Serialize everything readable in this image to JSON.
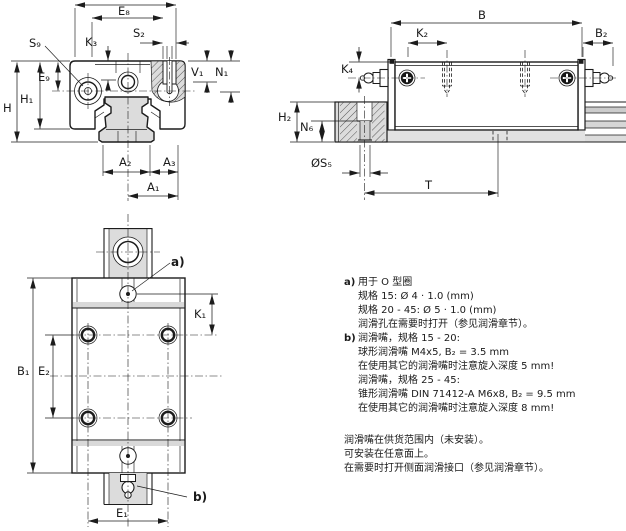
{
  "drawing": {
    "front_view": {
      "labels": {
        "e8": "E₈",
        "s9": "S₉",
        "k3": "K₃",
        "s2": "S₂",
        "v1": "V₁",
        "n1": "N₁",
        "h": "H",
        "h1": "H₁",
        "e9": "E₉",
        "a2": "A₂",
        "a3": "A₃",
        "a1": "A₁"
      }
    },
    "side_view": {
      "labels": {
        "b": "B",
        "k2": "K₂",
        "b2": "B₂",
        "k4": "K₄",
        "h2": "H₂",
        "n6": "N₆",
        "s5": "ØS₅",
        "t": "T"
      }
    },
    "top_view": {
      "labels": {
        "a_marker": "a)",
        "b_marker": "b)",
        "k1": "K₁",
        "b1": "B₁",
        "e2": "E₂",
        "e1": "E₁"
      }
    }
  },
  "notes": {
    "item_a": {
      "marker": "a)",
      "lines": [
        "用于 O 型圈",
        "规格 15: Ø 4 · 1.0 (mm)",
        "规格 20 - 45: Ø 5 · 1.0 (mm)",
        "润滑孔在需要时打开（参见润滑章节）。"
      ]
    },
    "item_b": {
      "marker": "b)",
      "lines": [
        "润滑嘴，规格 15 - 20:",
        "球形润滑嘴 M4x5, B₂ = 3.5 mm",
        "在使用其它的润滑嘴时注意旋入深度 5 mm!",
        "润滑嘴，规格 25 - 45:",
        "锥形润滑嘴 DIN 71412-A M6x8, B₂ = 9.5 mm",
        "在使用其它的润滑嘴时注意旋入深度 8 mm!"
      ]
    },
    "footer": [
      "润滑嘴在供货范围内（未安装）。",
      "可安装在任意面上。",
      "在需要时打开侧面润滑接口（参见润滑章节）。"
    ]
  },
  "colors": {
    "line": "#1c1c1c",
    "rail_fill": "#dcdcdc",
    "band_gray": "#d9d9d9",
    "background": "#ffffff"
  }
}
